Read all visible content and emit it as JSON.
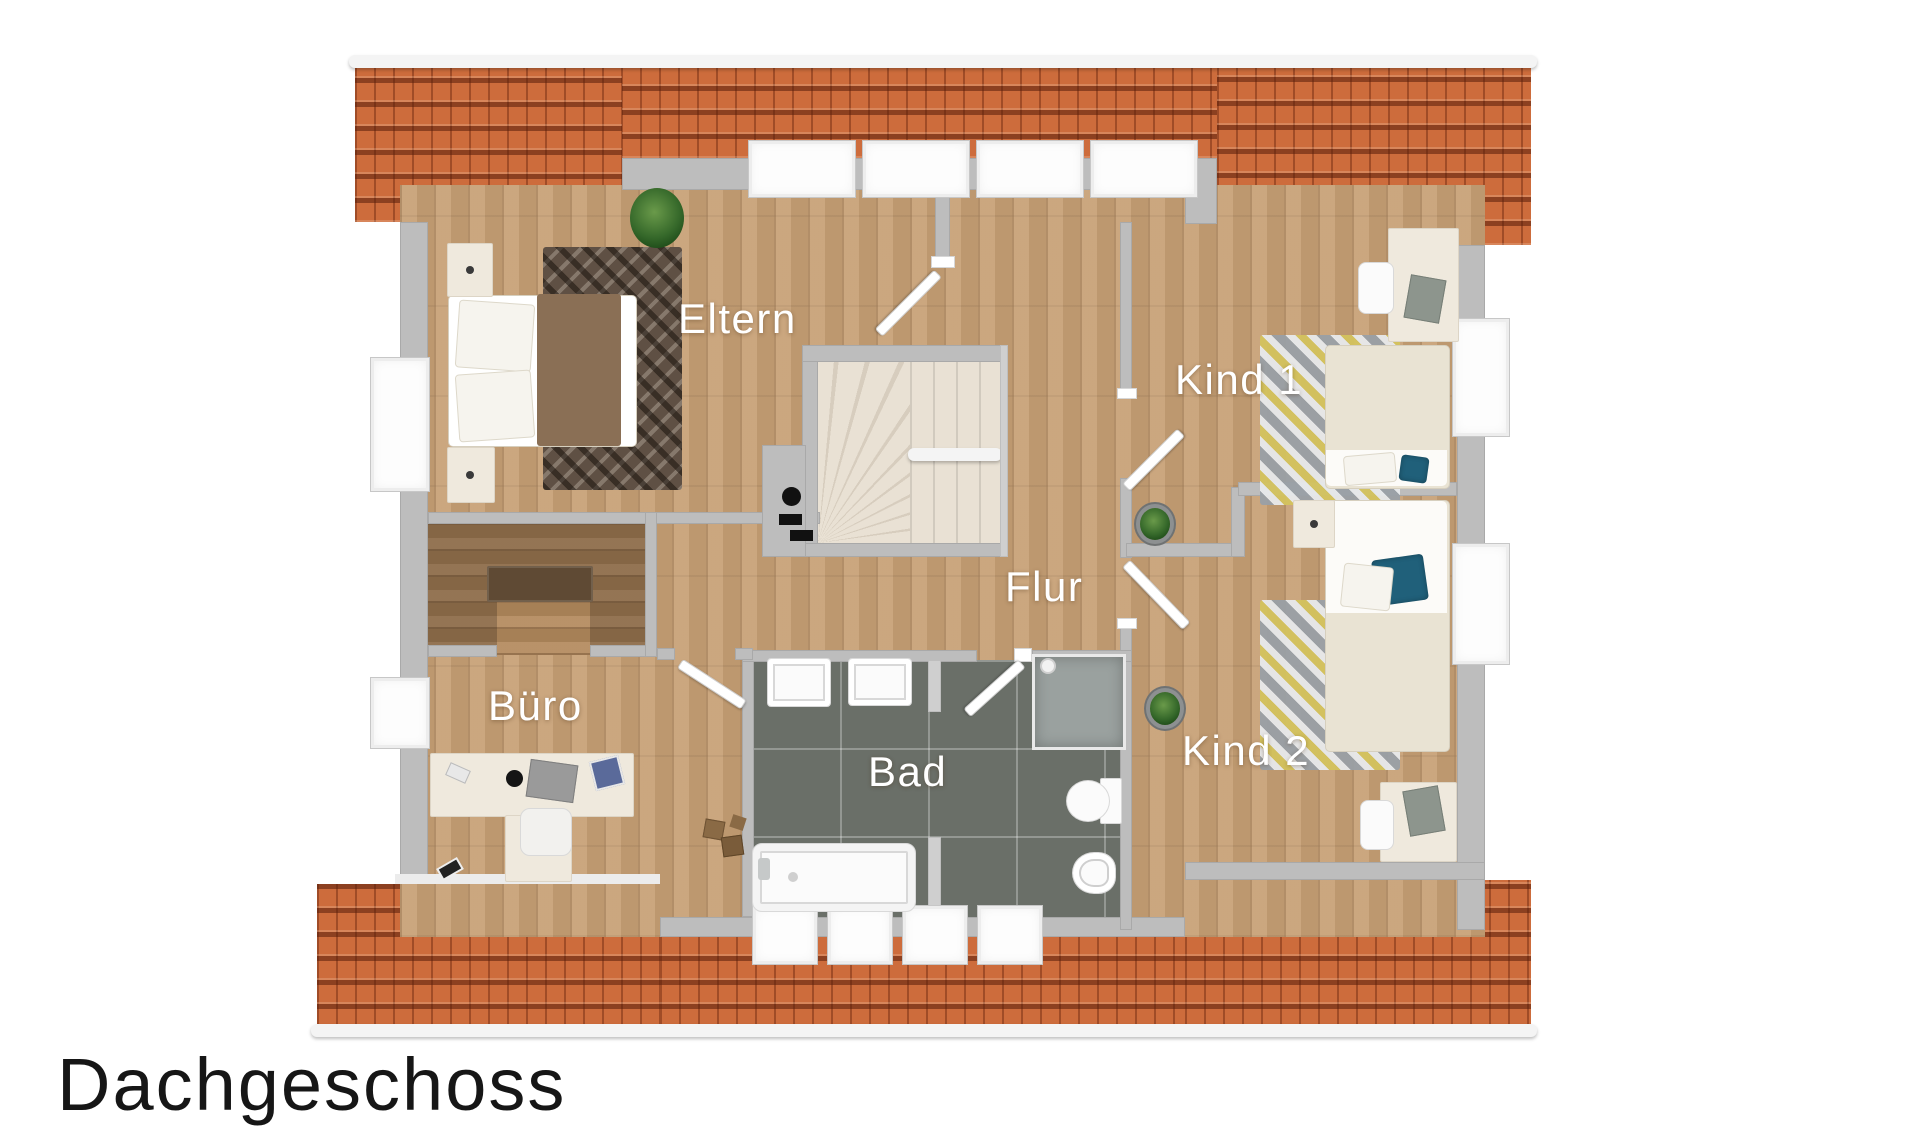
{
  "title": {
    "text": "Dachgeschoss"
  },
  "floor_plan": {
    "floor_name": "Dachgeschoss",
    "rooms": [
      {
        "id": "eltern",
        "label": "Eltern"
      },
      {
        "id": "kind1",
        "label": "Kind 1"
      },
      {
        "id": "flur",
        "label": "Flur"
      },
      {
        "id": "kind2",
        "label": "Kind 2"
      },
      {
        "id": "buero",
        "label": "Büro"
      },
      {
        "id": "bad",
        "label": "Bad"
      }
    ],
    "features": [
      "roof-tiles-top",
      "roof-tiles-bottom",
      "winder-staircase",
      "chimney",
      "bathtub",
      "shower",
      "toilet",
      "bidet",
      "double-sink",
      "double-bed",
      "two-single-beds",
      "office-desk",
      "two-kids-desks",
      "walk-in-closet",
      "four-dormer-windows-top",
      "four-dormer-windows-bottom"
    ]
  },
  "colors": {
    "roof": "#cd6c3c",
    "ridge": "#f4f4f4",
    "wall": "#bdbdbd",
    "wood_light": "#c7a075",
    "wood_dark": "#8d6c49",
    "bath_tile": "#6a6f68",
    "stairs": "#e8e0d3",
    "rug_eltern": "#5f5044",
    "rug_kids_gray": "#9aa0a6",
    "rug_kids_yellow": "#d4c35e",
    "pillow_teal": "#20607a",
    "bed_cream": "#e9e3d3",
    "label_text": "#ffffff",
    "title_text": "#161616"
  }
}
